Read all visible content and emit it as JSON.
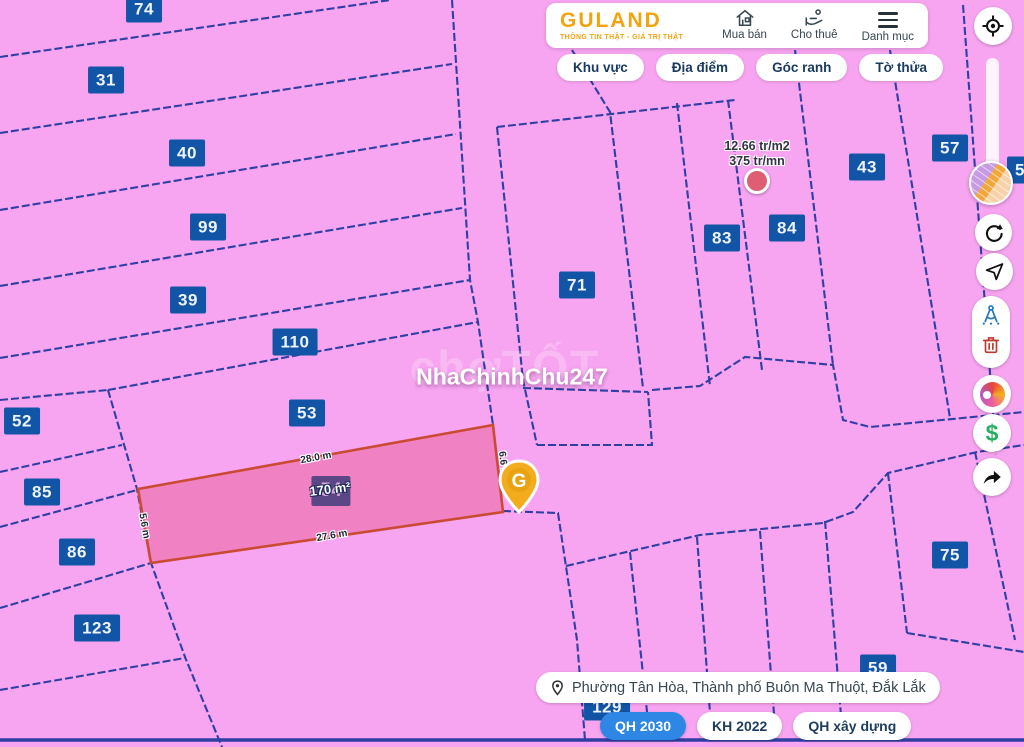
{
  "colors": {
    "map_bg": "#F8A5F1",
    "line_blue": "#2F3FA3",
    "label_blue": "#1254A6",
    "selected_fill": "rgba(226,62,106,0.35)",
    "selected_stroke": "#C94B33",
    "brand_gold": "#F2A410",
    "plan_active_blue": "#2E86E5",
    "price_dot": "#DE5F73"
  },
  "header": {
    "logo": "GULAND",
    "tagline": "THÔNG TIN THẬT - GIÁ TRỊ THẬT",
    "nav": [
      {
        "label": "Mua bán",
        "icon": "house-search-icon"
      },
      {
        "label": "Cho thuê",
        "icon": "hand-building-icon"
      },
      {
        "label": "Danh mục",
        "icon": "menu-icon"
      }
    ]
  },
  "filters": {
    "items": [
      {
        "label": "Khu vực"
      },
      {
        "label": "Địa điểm"
      },
      {
        "label": "Góc ranh"
      },
      {
        "label": "Tờ thửa"
      }
    ]
  },
  "sidebar": {
    "dollar_glyph": "$"
  },
  "price_marker": {
    "line1": "12.66 tr/m2",
    "line2": "375 tr/mn",
    "x": 757,
    "y": 181
  },
  "watermark": {
    "main": "NhaChinhChu247",
    "ghost": "chợTỐT",
    "main_x": 512,
    "main_y": 377,
    "ghost_x": 505,
    "ghost_y": 367
  },
  "selected_parcel": {
    "number": "54",
    "area": "170 m²",
    "cx": 331,
    "cy": 491,
    "points": "138,489 493,425 503,512 151,563",
    "pin_x": 519,
    "pin_y": 520,
    "measurements": [
      {
        "text": "28.0 m",
        "x": 316,
        "y": 458,
        "rot": -10.5
      },
      {
        "text": "27.6 m",
        "x": 332,
        "y": 536,
        "rot": -10
      },
      {
        "text": "5.6 m",
        "x": 144,
        "y": 526,
        "rot": 80
      },
      {
        "text": "6.6 m",
        "x": 503,
        "y": 464,
        "rot": 83
      }
    ]
  },
  "parcels": [
    {
      "n": "74",
      "x": 144,
      "y": 9
    },
    {
      "n": "31",
      "x": 106,
      "y": 80
    },
    {
      "n": "40",
      "x": 187,
      "y": 153
    },
    {
      "n": "99",
      "x": 208,
      "y": 227
    },
    {
      "n": "39",
      "x": 188,
      "y": 300
    },
    {
      "n": "110",
      "x": 295,
      "y": 342
    },
    {
      "n": "53",
      "x": 307,
      "y": 413
    },
    {
      "n": "52",
      "x": 22,
      "y": 421
    },
    {
      "n": "85",
      "x": 42,
      "y": 492
    },
    {
      "n": "86",
      "x": 77,
      "y": 552
    },
    {
      "n": "123",
      "x": 97,
      "y": 628
    },
    {
      "n": "71",
      "x": 577,
      "y": 285
    },
    {
      "n": "83",
      "x": 722,
      "y": 238
    },
    {
      "n": "84",
      "x": 787,
      "y": 228
    },
    {
      "n": "43",
      "x": 867,
      "y": 167
    },
    {
      "n": "57",
      "x": 950,
      "y": 148
    },
    {
      "n": "5",
      "x": 1020,
      "y": 170
    },
    {
      "n": "75",
      "x": 950,
      "y": 555
    },
    {
      "n": "59",
      "x": 878,
      "y": 668
    },
    {
      "n": "129",
      "x": 607,
      "y": 707
    }
  ],
  "map_lines": [
    [
      0,
      57,
      390,
      0
    ],
    [
      0,
      133,
      452,
      64
    ],
    [
      0,
      210,
      456,
      134
    ],
    [
      0,
      286,
      462,
      208
    ],
    [
      0,
      358,
      470,
      280
    ],
    [
      0,
      400,
      108,
      390
    ],
    [
      108,
      390,
      478,
      322
    ],
    [
      108,
      390,
      137,
      489,
      151,
      563,
      185,
      657,
      222,
      747
    ],
    [
      0,
      472,
      122,
      445
    ],
    [
      0,
      527,
      137,
      490
    ],
    [
      0,
      608,
      151,
      563
    ],
    [
      0,
      690,
      185,
      658
    ],
    [
      452,
      0,
      470,
      280,
      478,
      322,
      493,
      425
    ],
    [
      503,
      511,
      558,
      513,
      577,
      640,
      585,
      740
    ],
    [
      497,
      127,
      523,
      380,
      537,
      445
    ],
    [
      537,
      445,
      652,
      445,
      648,
      392
    ],
    [
      497,
      127,
      735,
      100
    ],
    [
      572,
      50,
      610,
      112,
      643,
      388
    ],
    [
      677,
      103,
      710,
      386
    ],
    [
      728,
      100,
      762,
      370
    ],
    [
      795,
      50,
      833,
      365
    ],
    [
      890,
      50,
      950,
      418
    ],
    [
      963,
      5,
      996,
      455
    ],
    [
      523,
      388,
      648,
      392
    ],
    [
      652,
      390,
      700,
      386,
      745,
      357,
      833,
      365,
      843,
      420,
      870,
      427,
      1024,
      412
    ],
    [
      566,
      566,
      700,
      535,
      823,
      523,
      853,
      512,
      888,
      473,
      977,
      452,
      1024,
      445
    ],
    [
      697,
      537,
      712,
      740
    ],
    [
      760,
      531,
      776,
      740
    ],
    [
      825,
      521,
      843,
      740
    ],
    [
      888,
      473,
      907,
      633
    ],
    [
      907,
      633,
      1024,
      652
    ],
    [
      975,
      452,
      1015,
      640
    ],
    [
      630,
      552,
      650,
      740
    ],
    [
      0,
      740,
      1024,
      740
    ]
  ],
  "bottom": {
    "address": "Phường Tân Hòa, Thành phố Buôn Ma Thuột, Đắk Lắk",
    "plans": [
      {
        "label": "QH 2030",
        "active": true
      },
      {
        "label": "KH 2022",
        "active": false
      },
      {
        "label": "QH xây dựng",
        "active": false
      }
    ]
  }
}
